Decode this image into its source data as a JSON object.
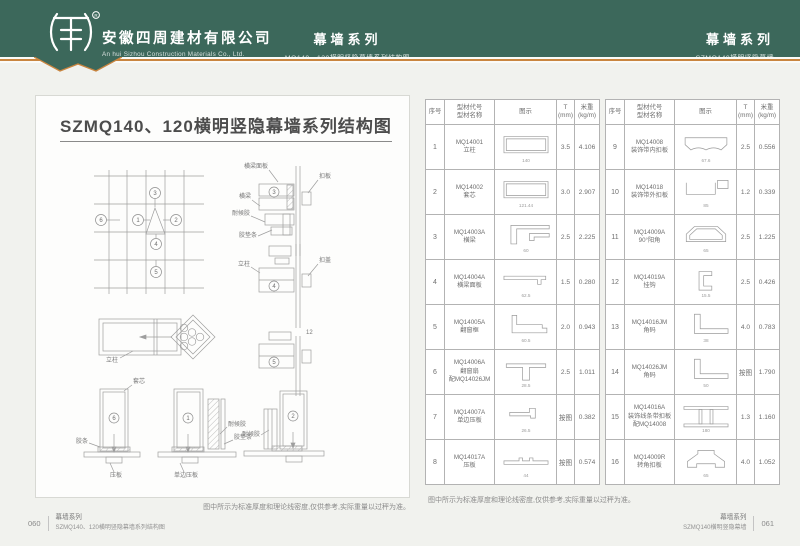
{
  "colors": {
    "header_bg": "#3c685b",
    "accent_line": "#c9853f",
    "page_bg": "#f1f2ee"
  },
  "header": {
    "company_cn": "安徽四周建材有限公司",
    "company_en": "An hui Sizhou Construction Materials Co., Ltd.",
    "center_series": "幕墙系列",
    "center_subtitle": "MQ140、120横明竖隐幕墙系列结构图",
    "right_series": "幕墙系列",
    "right_subtitle": "SZMQ140横明竖隐幕墙"
  },
  "left_page": {
    "title": "SZMQ140、120横明竖隐幕墙系列结构图",
    "note": "图中所示为标准厚度和理论线密度,仅供参考,实际重量以过秤为准。",
    "callouts": {
      "n1": "1",
      "n2": "2",
      "n3": "3",
      "n4": "4",
      "n5": "5",
      "n6": "6"
    },
    "labels": {
      "beam_panel": "横梁面板",
      "kou_ban": "扣板",
      "beam": "横梁",
      "weather_seal": "耐候胶",
      "gasket": "胶垫条",
      "kou_gai": "扣盖",
      "mullion": "立柱",
      "core": "套芯",
      "rubber_strip": "胶条",
      "press_plate": "压板",
      "single_press_plate": "单边压板",
      "dim12": "12"
    },
    "footer": {
      "page_no": "060",
      "series": "幕墙系列",
      "doc": "SZMQ140、120横明竖隐幕墙系列结构图"
    }
  },
  "right_page": {
    "table": {
      "headers": {
        "no": "序号",
        "code1": "型材代号",
        "code2": "型材名称",
        "fig": "图示",
        "t1": "T",
        "t2": "(mm)",
        "w1": "米重",
        "w2": "(kg/m)"
      },
      "rows": [
        {
          "no": "1",
          "code": "MQ14001",
          "name": "立柱",
          "extra": "",
          "t": "3.5",
          "w": "4.106",
          "shape": "tube",
          "dim": "140"
        },
        {
          "no": "2",
          "code": "MQ14002",
          "name": "套芯",
          "extra": "",
          "t": "3.0",
          "w": "2.907",
          "shape": "tube",
          "dim": "121.44"
        },
        {
          "no": "3",
          "code": "MQ14003A",
          "name": "横梁",
          "extra": "",
          "t": "2.5",
          "w": "2.225",
          "shape": "beam_t",
          "dim": "60"
        },
        {
          "no": "4",
          "code": "MQ14004A",
          "name": "横梁面板",
          "extra": "",
          "t": "1.5",
          "w": "0.280",
          "shape": "flat",
          "dim": "62.5"
        },
        {
          "no": "5",
          "code": "MQ14005A",
          "name": "翻窗框",
          "extra": "",
          "t": "2.0",
          "w": "0.943",
          "shape": "step",
          "dim": "60.5"
        },
        {
          "no": "6",
          "code": "MQ14006A",
          "name": "翻窗扇",
          "extra": "配MQ14026JM",
          "t": "2.5",
          "w": "1.011",
          "shape": "tee_down",
          "dim": "28.5"
        },
        {
          "no": "7",
          "code": "MQ14007A",
          "name": "单边压板",
          "extra": "",
          "t": "按图",
          "w": "0.382",
          "shape": "clip",
          "dim": "26.5"
        },
        {
          "no": "8",
          "code": "MQ14017A",
          "name": "压板",
          "extra": "",
          "t": "按图",
          "w": "0.574",
          "shape": "flat_clip",
          "dim": "44"
        },
        {
          "no": "9",
          "code": "MQ14008",
          "name": "装饰带内扣板",
          "extra": "",
          "t": "2.5",
          "w": "0.556",
          "shape": "arch",
          "dim": "67.6"
        },
        {
          "no": "10",
          "code": "MQ14018",
          "name": "装饰带外扣板",
          "extra": "",
          "t": "1.2",
          "w": "0.339",
          "shape": "channel",
          "dim": "85"
        },
        {
          "no": "11",
          "code": "MQ14009A",
          "name": "90°阳角",
          "extra": "",
          "t": "2.5",
          "w": "1.225",
          "shape": "hex",
          "dim": "65"
        },
        {
          "no": "12",
          "code": "MQ14019A",
          "name": "挂钩",
          "extra": "",
          "t": "2.5",
          "w": "0.426",
          "shape": "c_small",
          "dim": "15.5"
        },
        {
          "no": "13",
          "code": "MQ14016JM",
          "name": "角码",
          "extra": "",
          "t": "4.0",
          "w": "0.783",
          "shape": "angle",
          "dim": "38"
        },
        {
          "no": "14",
          "code": "MQ14026JM",
          "name": "角码",
          "extra": "",
          "t": "按图",
          "w": "1.790",
          "shape": "angle",
          "dim": "50"
        },
        {
          "no": "15",
          "code": "MQ14016A",
          "name": "装饰线条带扣板",
          "extra": "配MQ14008",
          "t": "1.3",
          "w": "1.160",
          "shape": "h_frame",
          "dim": "180"
        },
        {
          "no": "16",
          "code": "MQ14009R",
          "name": "转角扣板",
          "extra": "",
          "t": "4.0",
          "w": "1.052",
          "shape": "trap",
          "dim": "65"
        }
      ]
    },
    "note": "图中所示为标准厚度和理论线密度,仅供参考,实际重量以过秤为准。",
    "footer": {
      "series": "幕墙系列",
      "doc": "SZMQ140横明竖隐幕墙",
      "page_no": "061"
    }
  }
}
